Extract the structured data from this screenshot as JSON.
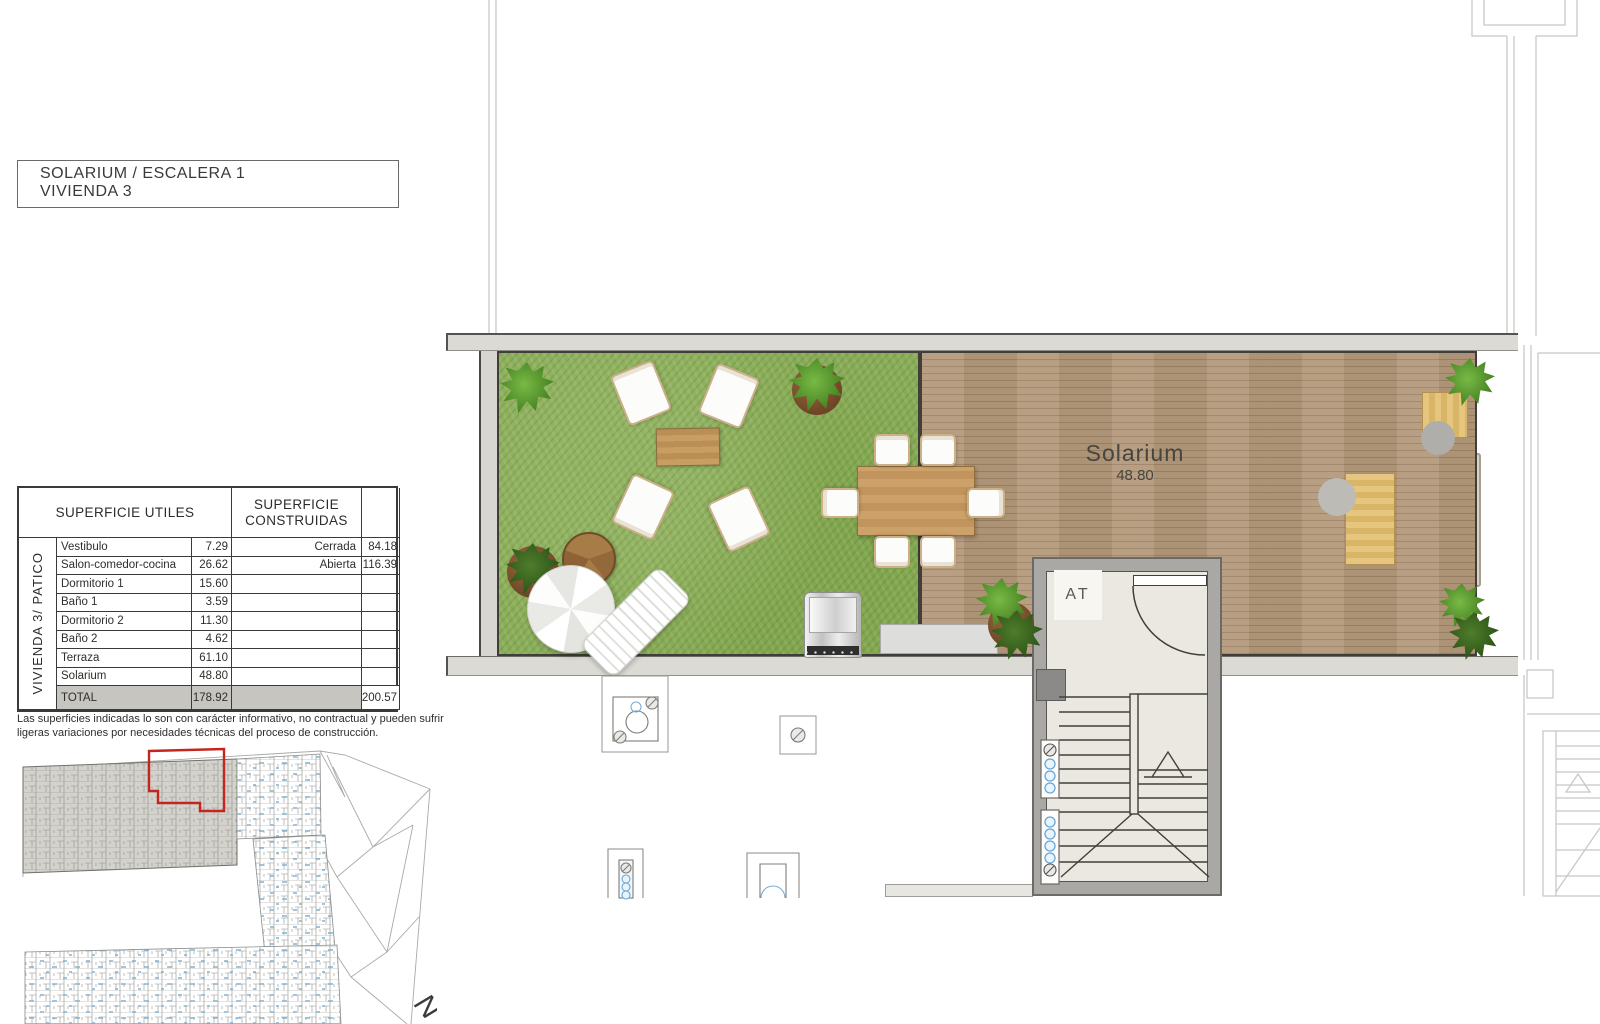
{
  "title": {
    "line1": "SOLARIUM / ESCALERA 1",
    "line2": "VIVIENDA 3"
  },
  "table": {
    "header_left": "SUPERFICIE UTILES",
    "header_right": "SUPERFICIE CONSTRUIDAS",
    "side_label": "VIVIENDA  3/ PATICO",
    "rows": [
      {
        "name": "Vestibulo",
        "value": "7.29",
        "right_label": "Cerrada",
        "right_value": "84.18"
      },
      {
        "name": "Salon-comedor-cocina",
        "value": "26.62",
        "right_label": "Abierta",
        "right_value": "116.39"
      },
      {
        "name": "Dormitorio 1",
        "value": "15.60",
        "right_label": "",
        "right_value": ""
      },
      {
        "name": "Baño 1",
        "value": "3.59",
        "right_label": "",
        "right_value": ""
      },
      {
        "name": "Dormitorio 2",
        "value": "11.30",
        "right_label": "",
        "right_value": ""
      },
      {
        "name": "Baño 2",
        "value": "4.62",
        "right_label": "",
        "right_value": ""
      },
      {
        "name": "Terraza",
        "value": "61.10",
        "right_label": "",
        "right_value": ""
      },
      {
        "name": "Solarium",
        "value": "48.80",
        "right_label": "",
        "right_value": ""
      }
    ],
    "total": {
      "name": "TOTAL",
      "value": "178.92",
      "right_value": "200.57"
    }
  },
  "disclaimer": "Las superficies indicadas lo son con carácter informativo, no contractual y pueden sufrir ligeras variaciones por necesidades técnicas del proceso de construcción.",
  "plan": {
    "room_label": "Solarium",
    "room_area": "48.80",
    "stair_label": "AT"
  },
  "north_label": "N",
  "colors": {
    "highlight_red": "#c4251c",
    "grass_green": "#8aad58",
    "deck_wood": "#b49a7c",
    "wall_gray": "#dcdad5",
    "stair_gray": "#a9a8a5",
    "shaft_blue": "#79add6"
  }
}
